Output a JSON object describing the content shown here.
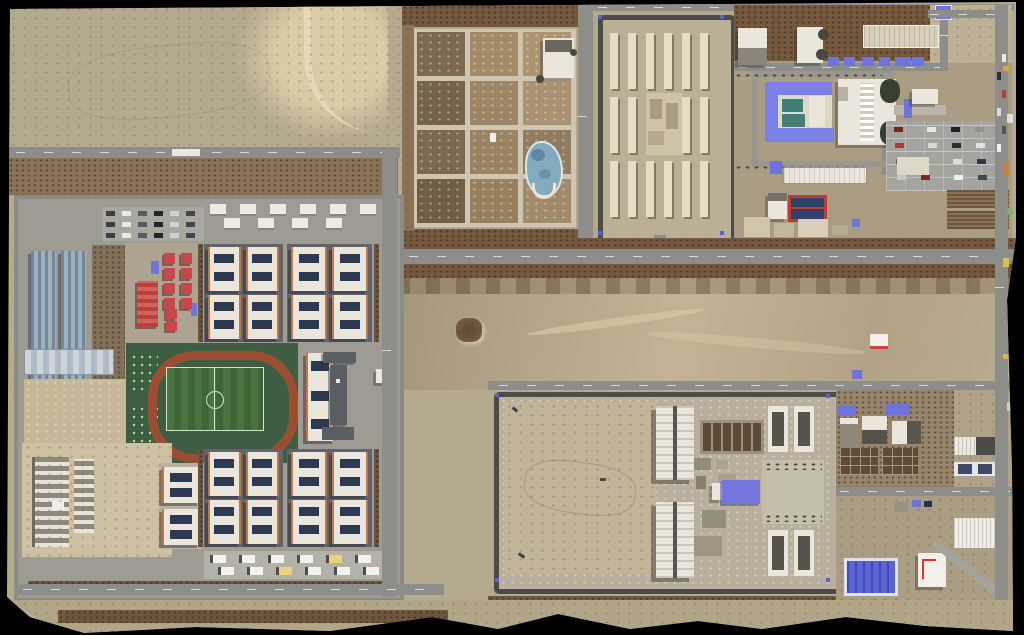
{
  "meta": {
    "title": "Satellite image of desert facility complex",
    "description": "Overhead satellite photograph: residential compound with sports track (west), agricultural plot grid and walled barracks compound (north), administration compound with courtyard building and parking lot (north-east), large walled compound with exercise yards (south-east), surrounded by desert; black warped photo edges.",
    "width": 1024,
    "height": 635
  },
  "palette": {
    "sand": "#b4aa8d",
    "sand-light": "#d8cca6",
    "sand-dark": "#9a8c6f",
    "dirt-brown": "#74593e",
    "dirt-mid": "#8a7254",
    "plot-path": "#cfc6b1",
    "road": "#8d8d89",
    "ground-grey": "#9e9c92",
    "wall-dark": "#4c4b47",
    "barrack": "#e5ddc6",
    "bld-white": "#eae6db",
    "bld-dark": "#56534d",
    "apt-edge": "#c0774a",
    "solar": "#2c3950",
    "red-bld": "#c8474b",
    "track-red": "#9a4f33",
    "field-green": "#477039",
    "pitch-dark-green": "#3f5d42",
    "teal-court": "#3e7e77",
    "court-blue": "#2e4066",
    "court-red": "#bf3b30",
    "blue-roof": "#6f74dd",
    "warehouse-blue": "#5b63d6",
    "warehouse-grey-blue": "#9db0c0",
    "pond-blue": "#83abc0",
    "tree": "#45483a",
    "shadow": "#55555b",
    "black-edge": "#000000"
  },
  "counts": {
    "farm_plots": 12,
    "barrack_rows": 3,
    "barracks_per_row": 6,
    "apartment_blocks": 4,
    "buildings_per_block": 4,
    "solar_panels_per_building": 2,
    "red_huts": 10,
    "admin_blue_roofs": 6,
    "admin_parking_cars": 16,
    "staff_parking_cars": 18,
    "white_service_buildings": 10,
    "parked_vehicles_row": 12,
    "exercise_strips": 6,
    "road_cars_east": 6
  },
  "colors_lists": {
    "farm_plots": [
      "#7b6a51",
      "#a38b68",
      "#ac9473",
      "#75644c",
      "#9d8565",
      "#a99171",
      "#7b6a51",
      "#9b8463",
      "#907d61",
      "#705f47",
      "#98815f",
      "#a28b6b"
    ],
    "parking_cars": [
      "#7a2020",
      "#e6e6e2",
      "#1e2126",
      "#8f9296",
      "#b03a30",
      "#d8d8d4",
      "#2b2f36",
      "#e2e2de",
      "#5a5e64",
      "#99311f",
      "#dcdcd8",
      "#33373d",
      "#c7c7c3",
      "#802525",
      "#efefeb",
      "#44484e"
    ],
    "staff_cars": [
      "#3a3d42",
      "#e8e8e4",
      "#555a61",
      "#23262b",
      "#cfd2d4",
      "#41464d"
    ],
    "edge_artifacts": [
      "#d8a93c",
      "#e0e0da",
      "#c97f35",
      "#7fae6a",
      "#d8c04a",
      "#b0b0a8",
      "#e0b24a",
      "#cdcdc7"
    ]
  },
  "labels": {
    "nw_desert": "empty desert with graded berm",
    "farm_compound": "agricultural plot grid with pond",
    "north_compound": "walled compound with barracks rows",
    "admin_compound": "administration compound with courtyard building, basketball courts and parking",
    "left_compound": "residential compound with warehouses, red huts, apartment blocks and sports track",
    "south_compound": "large walled compound with empty yard, cell blocks and exercise strips",
    "annex": "service annex with greenhouses and blue warehouse"
  }
}
